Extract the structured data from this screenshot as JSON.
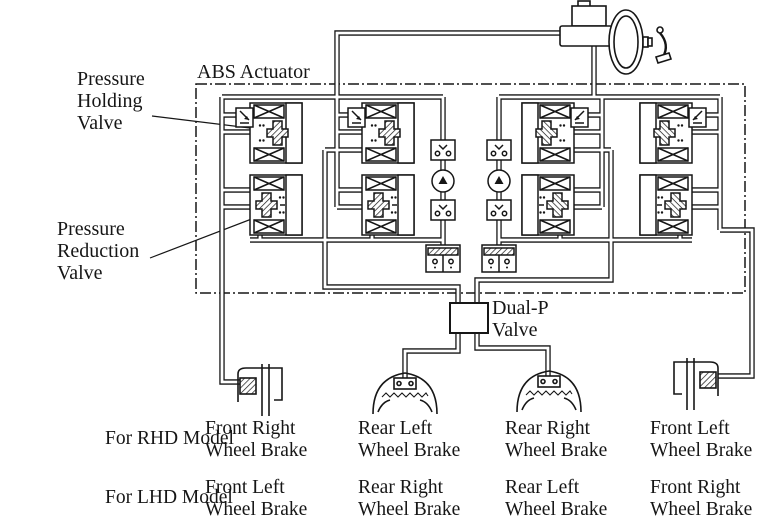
{
  "colors": {
    "ink": "#161616",
    "paper": "#ffffff"
  },
  "labels": {
    "abs_actuator": "ABS Actuator",
    "pressure_holding_valve": [
      "Pressure",
      "Holding",
      "Valve"
    ],
    "pressure_reduction_valve": [
      "Pressure",
      "Reduction",
      "Valve"
    ],
    "dual_p_valve": [
      "Dual-P",
      "Valve"
    ]
  },
  "legend": {
    "rows": [
      {
        "model": "For RHD Model",
        "cols": [
          [
            "Front Right",
            "Wheel Brake"
          ],
          [
            "Rear Left",
            "Wheel Brake"
          ],
          [
            "Rear Right",
            "Wheel Brake"
          ],
          [
            "Front Left",
            "Wheel Brake"
          ]
        ]
      },
      {
        "model": "For LHD Model",
        "cols": [
          [
            "Front Left",
            "Wheel Brake"
          ],
          [
            "Rear Right",
            "Wheel Brake"
          ],
          [
            "Rear Left",
            "Wheel Brake"
          ],
          [
            "Front Right",
            "Wheel Brake"
          ]
        ]
      }
    ]
  },
  "components": {
    "master_cylinder": "master-cylinder-with-booster-and-pedal",
    "pressure_holding_valves": 4,
    "pressure_reduction_valves": 4,
    "pumps": 2,
    "check_valves": 4,
    "accumulators": 2,
    "dual_p_valve": 1,
    "disc_brakes": 2,
    "drum_brakes": 2
  }
}
